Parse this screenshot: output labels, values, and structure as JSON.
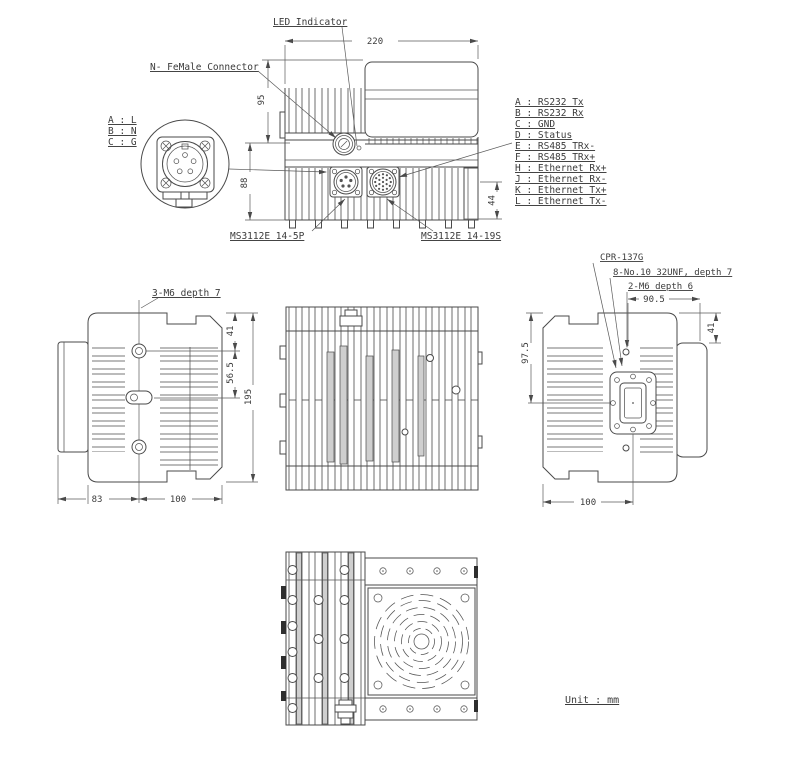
{
  "meta": {
    "unit_note": "Unit : mm"
  },
  "front_view": {
    "labels": {
      "led_indicator": "LED Indicator",
      "n_female_connector": "N- FeMale Connector",
      "connector_5p": "MS3112E 14-5P",
      "connector_19s": "MS3112E 14-19S"
    },
    "dimensions": {
      "overall_width": "220",
      "upper_height": "95",
      "lower_height": "88",
      "connector_offset": "44"
    }
  },
  "power_pin_detail": {
    "lines": [
      "A : L",
      "B : N",
      "C : G"
    ]
  },
  "signal_pinout": {
    "lines": [
      "A : RS232 Tx",
      "B : RS232 Rx",
      "C : GND",
      "D : Status",
      "E : RS485 TRx-",
      "F : RS485 TRx+",
      "H : Ethernet Rx+",
      "J : Ethernet Rx-",
      "K : Ethernet Tx+",
      "L : Ethernet Tx-"
    ]
  },
  "left_side_view": {
    "labels": {
      "mounting_holes": "3-M6 depth 7"
    },
    "dimensions": {
      "hole_offset_top": "41",
      "hole_spacing": "56.5",
      "overall_height": "195",
      "lid_depth": "83",
      "body_depth": "100"
    }
  },
  "right_side_view": {
    "labels": {
      "waveguide_flange": "CPR-137G",
      "flange_holes": "8-No.10 32UNF, depth 7",
      "m6_holes": "2-M6 depth 6"
    },
    "dimensions": {
      "flange_offset": "90.5",
      "cover_offset": "41",
      "flange_center_offset": "97.5",
      "body_depth": "100"
    }
  }
}
